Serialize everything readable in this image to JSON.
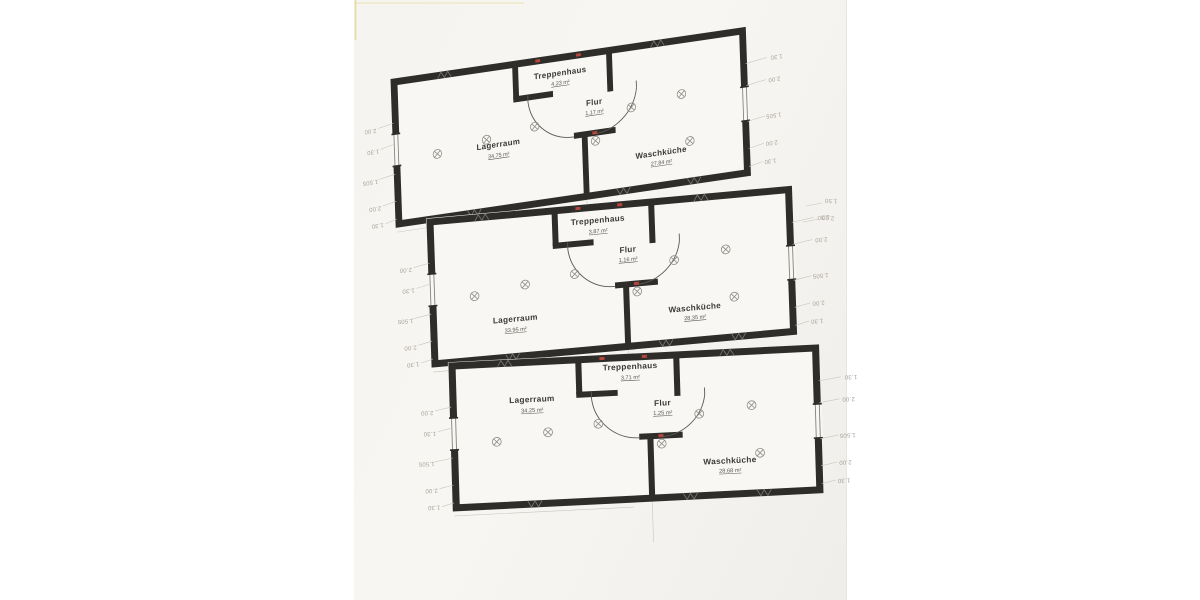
{
  "colors": {
    "wall": "#2f2d2a",
    "paper": "#f6f4f1",
    "slab": "#f8f7f4",
    "ink": "#3c3a37",
    "ink-soft": "#5a5751",
    "dim": "#a8a39a",
    "accent-red": "#b4453c",
    "thin": "#85827c"
  },
  "floors": [
    {
      "treppenhaus": {
        "name": "Treppenhaus",
        "area": "4.23 m²"
      },
      "flur": {
        "name": "Flur",
        "area": "1.17 m²"
      },
      "lagerraum": {
        "name": "Lagerraum",
        "area": "34.75 m²"
      },
      "waschkueche": {
        "name": "Waschküche",
        "area": "27.84 m²"
      }
    },
    {
      "treppenhaus": {
        "name": "Treppenhaus",
        "area": "3.87 m²"
      },
      "flur": {
        "name": "Flur",
        "area": "1.16 m²"
      },
      "lagerraum": {
        "name": "Lagerraum",
        "area": "33.95 m²"
      },
      "waschkueche": {
        "name": "Waschküche",
        "area": "28.35 m²"
      }
    },
    {
      "treppenhaus": {
        "name": "Treppenhaus",
        "area": "3.71 m²"
      },
      "flur": {
        "name": "Flur",
        "area": "1.25 m²"
      },
      "lagerraum": {
        "name": "Lagerraum",
        "area": "34.25 m²"
      },
      "waschkueche": {
        "name": "Waschküche",
        "area": "28.68 m²"
      }
    }
  ],
  "dims": {
    "d130": "1.30",
    "d200": "2.00",
    "d1505": "1.505",
    "d150": "1.50"
  }
}
